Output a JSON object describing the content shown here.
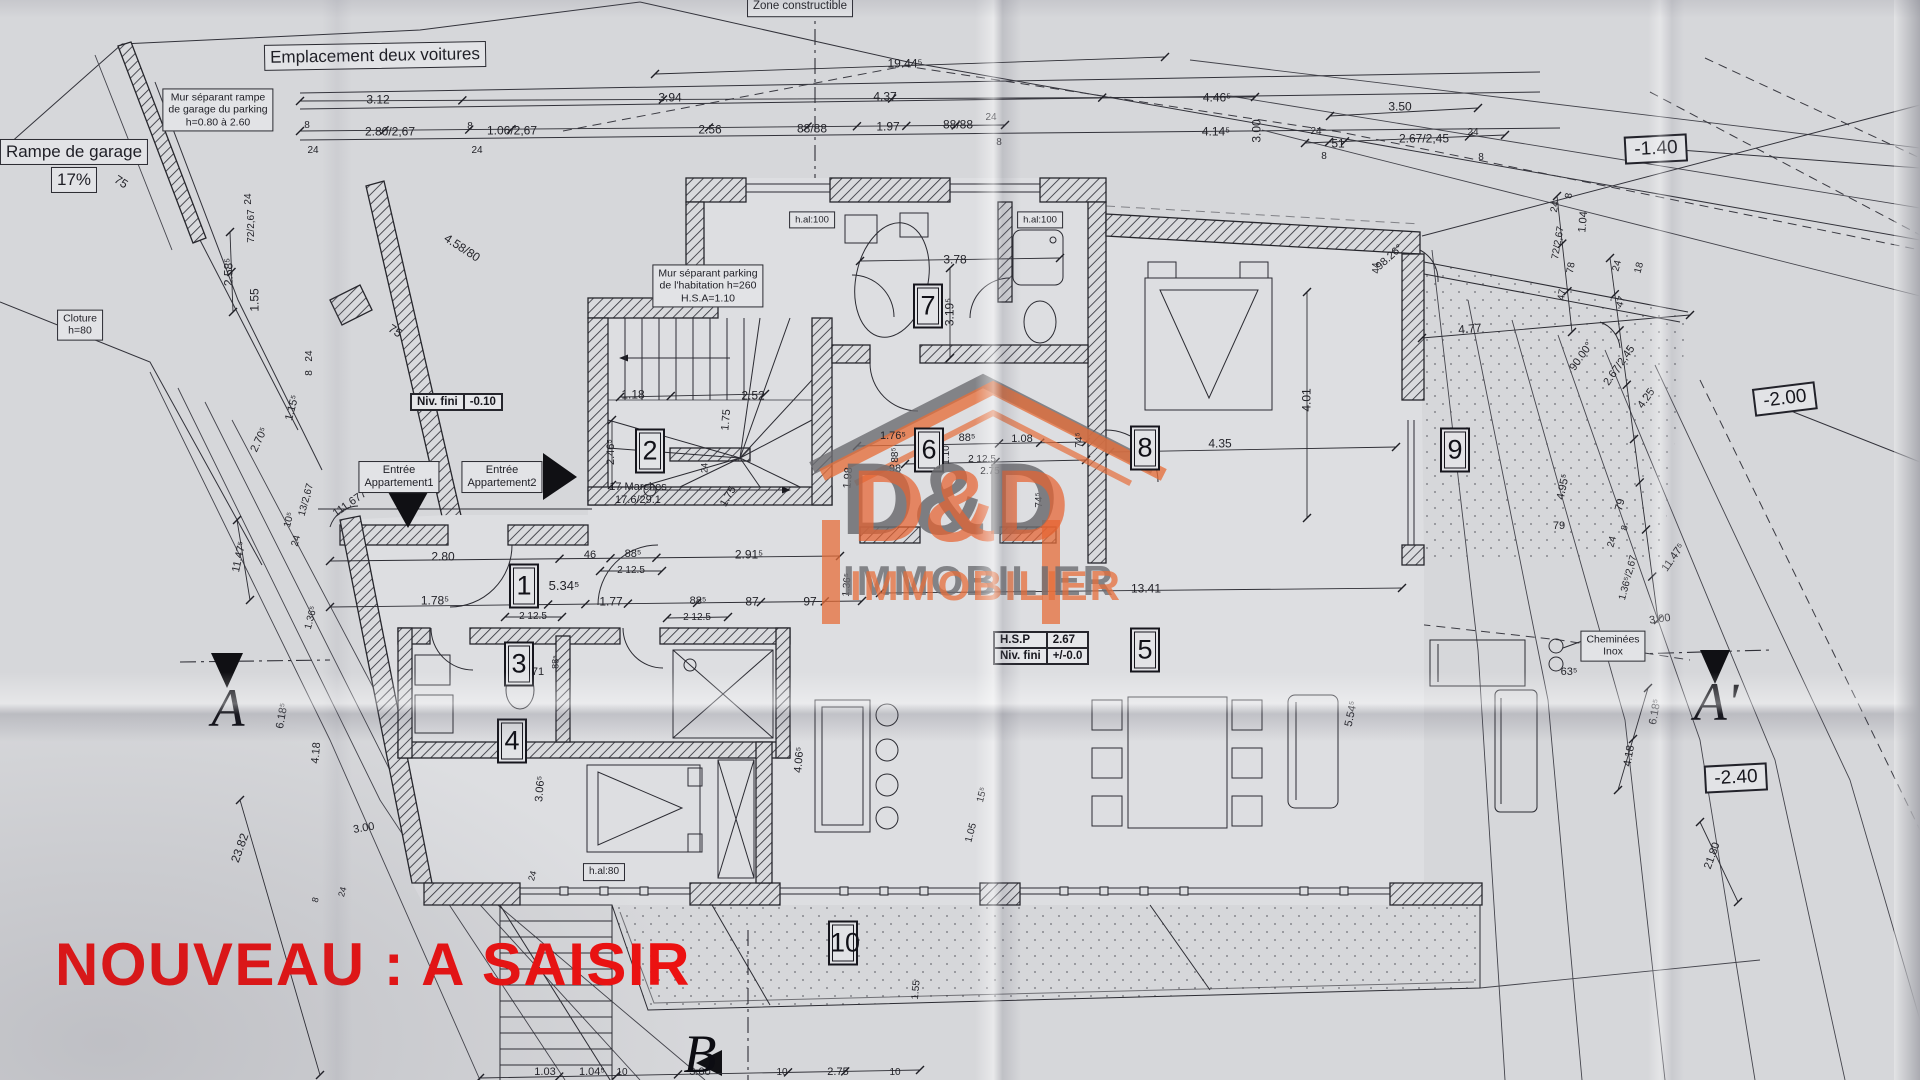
{
  "watermark": {
    "text": "NOUVEAU :  A SAISIR",
    "color": "#ec1111"
  },
  "logo": {
    "title": "D&D",
    "subtitle": "IMMOBILIER",
    "accent": "#e6623a",
    "shadow": "#6c6c70"
  },
  "plan": {
    "line_color": "#2b2b31",
    "paper_color": "#d6d7da",
    "rooms": [
      {
        "n": "1",
        "x": 524,
        "y": 586
      },
      {
        "n": "2",
        "x": 650,
        "y": 451
      },
      {
        "n": "3",
        "x": 519,
        "y": 664
      },
      {
        "n": "4",
        "x": 512,
        "y": 741
      },
      {
        "n": "5",
        "x": 1145,
        "y": 650
      },
      {
        "n": "6",
        "x": 929,
        "y": 450
      },
      {
        "n": "7",
        "x": 928,
        "y": 306
      },
      {
        "n": "8",
        "x": 1145,
        "y": 448
      },
      {
        "n": "9",
        "x": 1455,
        "y": 450
      },
      {
        "n": "10",
        "x": 843,
        "y": 943
      }
    ],
    "section_markers": [
      {
        "t": "A",
        "x": 228,
        "y": 708
      },
      {
        "t": "A'",
        "x": 1716,
        "y": 702
      },
      {
        "t": "B",
        "x": 700,
        "y": 1054
      }
    ],
    "elevation_boxes": [
      {
        "t": "-1.40",
        "x": 1656,
        "y": 149,
        "rot": -3
      },
      {
        "t": "-2.00",
        "x": 1785,
        "y": 399,
        "rot": -7
      },
      {
        "t": "-2.40",
        "x": 1736,
        "y": 778,
        "rot": -3
      }
    ],
    "boxed_labels": [
      {
        "lines": [
          "Emplacement deux voitures"
        ],
        "x": 375,
        "y": 56,
        "fs": 17,
        "rot": -1
      },
      {
        "lines": [
          "Mur séparant rampe",
          "de garage du parking",
          "h=0.80 à 2.60"
        ],
        "x": 218,
        "y": 110,
        "fs": 10.5
      },
      {
        "lines": [
          "Rampe de garage"
        ],
        "x": 74,
        "y": 152,
        "fs": 17
      },
      {
        "lines": [
          "17%"
        ],
        "x": 74,
        "y": 180,
        "fs": 17
      },
      {
        "lines": [
          "Cloture",
          "h=80"
        ],
        "x": 80,
        "y": 325,
        "fs": 10.5
      },
      {
        "lines": [
          "Zone constructible"
        ],
        "x": 800,
        "y": 7,
        "fs": 11.5
      },
      {
        "lines": [
          "Mur séparant parking",
          "de l'habitation h=260",
          "H.S.A=1.10"
        ],
        "x": 708,
        "y": 286,
        "fs": 10.5
      },
      {
        "lines": [
          "h.al:100"
        ],
        "x": 812,
        "y": 220,
        "fs": 9.5
      },
      {
        "lines": [
          "h.al:100"
        ],
        "x": 1040,
        "y": 220,
        "fs": 9.5
      },
      {
        "lines": [
          "Entrée",
          "Appartement1"
        ],
        "x": 399,
        "y": 477,
        "fs": 11
      },
      {
        "lines": [
          "Entrée",
          "Appartement2"
        ],
        "x": 502,
        "y": 477,
        "fs": 11
      },
      {
        "lines": [
          "17 Marches",
          "17.6/29.1"
        ],
        "x": 638,
        "y": 494,
        "fs": 11,
        "nobox": true
      },
      {
        "lines": [
          "h.al:80"
        ],
        "x": 604,
        "y": 872,
        "fs": 10
      },
      {
        "lines": [
          "Cheminées",
          "Inox"
        ],
        "x": 1613,
        "y": 646,
        "fs": 10.5
      }
    ],
    "info_tables": [
      {
        "x": 410,
        "y": 393,
        "rows": [
          [
            "Niv. fini",
            "-0.10"
          ]
        ]
      },
      {
        "x": 993,
        "y": 631,
        "rows": [
          [
            "H.S.P",
            "2.67"
          ],
          [
            "Niv. fini",
            "+/-0.0"
          ]
        ]
      }
    ],
    "dimensions": [
      {
        "t": "3.12",
        "x": 378,
        "y": 100
      },
      {
        "t": "8",
        "x": 307,
        "y": 126,
        "fs": 10
      },
      {
        "t": "24",
        "x": 313,
        "y": 151,
        "fs": 10
      },
      {
        "t": "2.80/2,67",
        "x": 390,
        "y": 132
      },
      {
        "t": "8",
        "x": 470,
        "y": 127,
        "fs": 10
      },
      {
        "t": "24",
        "x": 477,
        "y": 151,
        "fs": 10
      },
      {
        "t": "1.06/2,67",
        "x": 512,
        "y": 131
      },
      {
        "t": "2.56",
        "x": 710,
        "y": 130
      },
      {
        "t": "3.94",
        "x": 670,
        "y": 98
      },
      {
        "t": "4.37",
        "x": 885,
        "y": 97
      },
      {
        "t": "19.44⁵",
        "x": 905,
        "y": 64
      },
      {
        "t": "88/88",
        "x": 812,
        "y": 129
      },
      {
        "t": "1.97",
        "x": 888,
        "y": 127
      },
      {
        "t": "88/88",
        "x": 958,
        "y": 125
      },
      {
        "t": "24",
        "x": 991,
        "y": 118,
        "fs": 10
      },
      {
        "t": "8",
        "x": 999,
        "y": 143,
        "fs": 10
      },
      {
        "t": "4.46⁵",
        "x": 1217,
        "y": 98
      },
      {
        "t": "3.50",
        "x": 1400,
        "y": 107
      },
      {
        "t": "4.14⁵",
        "x": 1216,
        "y": 132
      },
      {
        "t": "3.00",
        "x": 1257,
        "y": 131,
        "r": -90
      },
      {
        "t": "24",
        "x": 1316,
        "y": 132,
        "fs": 10
      },
      {
        "t": "8",
        "x": 1324,
        "y": 157,
        "fs": 10
      },
      {
        "t": "51",
        "x": 1338,
        "y": 144
      },
      {
        "t": "2.67/2,45",
        "x": 1424,
        "y": 139
      },
      {
        "t": "24",
        "x": 1473,
        "y": 133,
        "fs": 10
      },
      {
        "t": "8",
        "x": 1481,
        "y": 158,
        "fs": 10
      },
      {
        "t": "75",
        "x": 121,
        "y": 182,
        "r": 33
      },
      {
        "t": "75",
        "x": 395,
        "y": 331,
        "r": 33
      },
      {
        "t": "4.58/80",
        "x": 462,
        "y": 248,
        "r": 33
      },
      {
        "t": "2.58⁵",
        "x": 229,
        "y": 272,
        "r": -90
      },
      {
        "t": "1.55",
        "x": 255,
        "y": 300,
        "r": -90
      },
      {
        "t": "72/2,67",
        "x": 252,
        "y": 226,
        "r": -90,
        "fs": 10
      },
      {
        "t": "24",
        "x": 249,
        "y": 199,
        "r": -90,
        "fs": 10
      },
      {
        "t": "1.15⁵",
        "x": 293,
        "y": 408,
        "r": -75,
        "fs": 11
      },
      {
        "t": "2.70⁵",
        "x": 260,
        "y": 440,
        "r": -65,
        "fs": 11
      },
      {
        "t": "111.677°",
        "x": 352,
        "y": 503,
        "r": -35,
        "fs": 11
      },
      {
        "t": "10⁵",
        "x": 290,
        "y": 520,
        "r": -75,
        "fs": 10
      },
      {
        "t": "24",
        "x": 297,
        "y": 541,
        "r": -75,
        "fs": 10
      },
      {
        "t": "13/2,67",
        "x": 307,
        "y": 500,
        "r": -75,
        "fs": 10
      },
      {
        "t": "24",
        "x": 310,
        "y": 356,
        "r": -90,
        "fs": 10
      },
      {
        "t": "8",
        "x": 310,
        "y": 373,
        "r": -90,
        "fs": 10
      },
      {
        "t": "11.47⁵",
        "x": 240,
        "y": 557,
        "r": -78,
        "fs": 11
      },
      {
        "t": "23.82",
        "x": 240,
        "y": 848,
        "r": -70
      },
      {
        "t": "6.18⁵",
        "x": 283,
        "y": 716,
        "r": -80,
        "fs": 11
      },
      {
        "t": "4.18",
        "x": 317,
        "y": 753,
        "r": -85,
        "fs": 11
      },
      {
        "t": "3.00",
        "x": 364,
        "y": 829,
        "r": -10,
        "fs": 11
      },
      {
        "t": "8",
        "x": 316,
        "y": 900,
        "r": -75,
        "fs": 9
      },
      {
        "t": "24",
        "x": 343,
        "y": 892,
        "r": -75,
        "fs": 9
      },
      {
        "t": "2.52",
        "x": 753,
        "y": 396
      },
      {
        "t": "1.18",
        "x": 633,
        "y": 395
      },
      {
        "t": "1.75",
        "x": 727,
        "y": 420,
        "r": -85,
        "fs": 11
      },
      {
        "t": "1.75",
        "x": 729,
        "y": 497,
        "r": -60,
        "fs": 11
      },
      {
        "t": "2.46⁵",
        "x": 612,
        "y": 452,
        "r": -90,
        "fs": 11
      },
      {
        "t": "24",
        "x": 705,
        "y": 468,
        "r": -90,
        "fs": 9
      },
      {
        "t": "3.78",
        "x": 955,
        "y": 260
      },
      {
        "t": "3.19⁵",
        "x": 950,
        "y": 312,
        "r": -90
      },
      {
        "t": "1.76⁵",
        "x": 893,
        "y": 437,
        "fs": 11
      },
      {
        "t": "88⁵",
        "x": 967,
        "y": 439,
        "fs": 11
      },
      {
        "t": "1.08",
        "x": 1022,
        "y": 440,
        "fs": 11
      },
      {
        "t": "2 12.5",
        "x": 982,
        "y": 460,
        "fs": 10
      },
      {
        "t": "2.75",
        "x": 990,
        "y": 472,
        "fs": 10
      },
      {
        "t": "98",
        "x": 895,
        "y": 470,
        "fs": 11
      },
      {
        "t": "1.98",
        "x": 849,
        "y": 478,
        "r": -85,
        "fs": 11
      },
      {
        "t": "1.10",
        "x": 947,
        "y": 455,
        "r": -90,
        "fs": 10
      },
      {
        "t": "88⁵",
        "x": 896,
        "y": 455,
        "r": -90,
        "fs": 10
      },
      {
        "t": "2 12.5",
        "x": 921,
        "y": 457,
        "r": -90,
        "fs": 9
      },
      {
        "t": "74⁵",
        "x": 1080,
        "y": 440,
        "r": -90,
        "fs": 10
      },
      {
        "t": "74⁵",
        "x": 1040,
        "y": 500,
        "r": -90,
        "fs": 10
      },
      {
        "t": "4.35",
        "x": 1220,
        "y": 444
      },
      {
        "t": "4.01",
        "x": 1307,
        "y": 400,
        "r": -90
      },
      {
        "t": "98.26°",
        "x": 1390,
        "y": 258,
        "r": -42,
        "fs": 11
      },
      {
        "t": "44",
        "x": 1377,
        "y": 268,
        "r": -90,
        "fs": 10
      },
      {
        "t": "90.00°",
        "x": 1582,
        "y": 357,
        "r": -55,
        "fs": 11
      },
      {
        "t": "4.77",
        "x": 1470,
        "y": 329,
        "r": -5
      },
      {
        "t": "8",
        "x": 1570,
        "y": 196,
        "r": -80,
        "fs": 10
      },
      {
        "t": "1.04",
        "x": 1584,
        "y": 222,
        "r": -85,
        "fs": 11
      },
      {
        "t": "72/2,67",
        "x": 1559,
        "y": 243,
        "r": -80,
        "fs": 10
      },
      {
        "t": "24",
        "x": 1556,
        "y": 207,
        "r": -80,
        "fs": 10
      },
      {
        "t": "47",
        "x": 1563,
        "y": 295,
        "r": -80,
        "fs": 10
      },
      {
        "t": "78",
        "x": 1572,
        "y": 268,
        "r": -80,
        "fs": 10
      },
      {
        "t": "24",
        "x": 1618,
        "y": 266,
        "r": -75,
        "fs": 10
      },
      {
        "t": "18",
        "x": 1640,
        "y": 268,
        "r": -75,
        "fs": 10
      },
      {
        "t": "47",
        "x": 1622,
        "y": 302,
        "r": -75,
        "fs": 10
      },
      {
        "t": "2.67/2,45",
        "x": 1620,
        "y": 366,
        "r": -55,
        "fs": 11
      },
      {
        "t": "4.25",
        "x": 1647,
        "y": 399,
        "r": -55,
        "fs": 11
      },
      {
        "t": "4.95⁵",
        "x": 1564,
        "y": 487,
        "r": -78,
        "fs": 11
      },
      {
        "t": "79",
        "x": 1559,
        "y": 527,
        "fs": 11
      },
      {
        "t": "79",
        "x": 1621,
        "y": 505,
        "r": -75,
        "fs": 11
      },
      {
        "t": "8",
        "x": 1625,
        "y": 528,
        "r": -75,
        "fs": 9
      },
      {
        "t": "24",
        "x": 1613,
        "y": 542,
        "r": -75,
        "fs": 10
      },
      {
        "t": "1.36⁵/2,67",
        "x": 1629,
        "y": 578,
        "r": -75,
        "fs": 10
      },
      {
        "t": "11.47⁵",
        "x": 1674,
        "y": 558,
        "r": -55,
        "fs": 11
      },
      {
        "t": "3.00",
        "x": 1660,
        "y": 620,
        "r": -8,
        "fs": 11
      },
      {
        "t": "63⁵",
        "x": 1569,
        "y": 673,
        "fs": 11
      },
      {
        "t": "6.18⁵",
        "x": 1656,
        "y": 712,
        "r": -80,
        "fs": 11
      },
      {
        "t": "4.18",
        "x": 1630,
        "y": 756,
        "r": -80,
        "fs": 11
      },
      {
        "t": "21.80",
        "x": 1713,
        "y": 856,
        "r": -70,
        "fs": 11
      },
      {
        "t": "2.80",
        "x": 443,
        "y": 557
      },
      {
        "t": "46",
        "x": 590,
        "y": 556,
        "fs": 11
      },
      {
        "t": "88⁵",
        "x": 633,
        "y": 555,
        "fs": 11
      },
      {
        "t": "2 12.5",
        "x": 631,
        "y": 571,
        "fs": 10
      },
      {
        "t": "2.91⁵",
        "x": 749,
        "y": 555
      },
      {
        "t": "5.34⁵",
        "x": 564,
        "y": 586,
        "fs": 13
      },
      {
        "t": "1.78⁵",
        "x": 435,
        "y": 601
      },
      {
        "t": "76",
        "x": 532,
        "y": 602,
        "fs": 10
      },
      {
        "t": "2 12.5",
        "x": 533,
        "y": 617,
        "fs": 10
      },
      {
        "t": "1.77",
        "x": 611,
        "y": 602
      },
      {
        "t": "88⁵",
        "x": 698,
        "y": 602,
        "fs": 11
      },
      {
        "t": "2 12.5",
        "x": 697,
        "y": 618,
        "fs": 10
      },
      {
        "t": "87",
        "x": 752,
        "y": 602
      },
      {
        "t": "97",
        "x": 810,
        "y": 602
      },
      {
        "t": "1.36⁵",
        "x": 848,
        "y": 585,
        "r": -85,
        "fs": 10
      },
      {
        "t": "1.36⁵",
        "x": 312,
        "y": 618,
        "r": -75,
        "fs": 10
      },
      {
        "t": "71",
        "x": 538,
        "y": 673,
        "fs": 11
      },
      {
        "t": "88⁵",
        "x": 556,
        "y": 662,
        "r": -90,
        "fs": 9
      },
      {
        "t": "13.41",
        "x": 1146,
        "y": 589
      },
      {
        "t": "3.06⁵",
        "x": 541,
        "y": 789,
        "r": -85,
        "fs": 11
      },
      {
        "t": "4.06⁵",
        "x": 800,
        "y": 760,
        "r": -85,
        "fs": 11
      },
      {
        "t": "24",
        "x": 533,
        "y": 876,
        "r": -75,
        "fs": 9
      },
      {
        "t": "5.54⁵",
        "x": 1352,
        "y": 714,
        "r": -78,
        "fs": 11
      },
      {
        "t": "1.03",
        "x": 545,
        "y": 1073,
        "fs": 11
      },
      {
        "t": "1.04⁵",
        "x": 592,
        "y": 1073,
        "fs": 11
      },
      {
        "t": "10",
        "x": 622,
        "y": 1073,
        "fs": 10
      },
      {
        "t": "3.00",
        "x": 700,
        "y": 1073,
        "fs": 11
      },
      {
        "t": "10",
        "x": 782,
        "y": 1073,
        "fs": 10
      },
      {
        "t": "2.75",
        "x": 838,
        "y": 1073,
        "fs": 11
      },
      {
        "t": "10",
        "x": 895,
        "y": 1073,
        "fs": 10
      },
      {
        "t": "1.55",
        "x": 917,
        "y": 990,
        "r": -85,
        "fs": 10
      },
      {
        "t": "15⁵",
        "x": 983,
        "y": 795,
        "r": -75,
        "fs": 10
      },
      {
        "t": "1.05",
        "x": 972,
        "y": 833,
        "r": -75,
        "fs": 10
      }
    ]
  }
}
